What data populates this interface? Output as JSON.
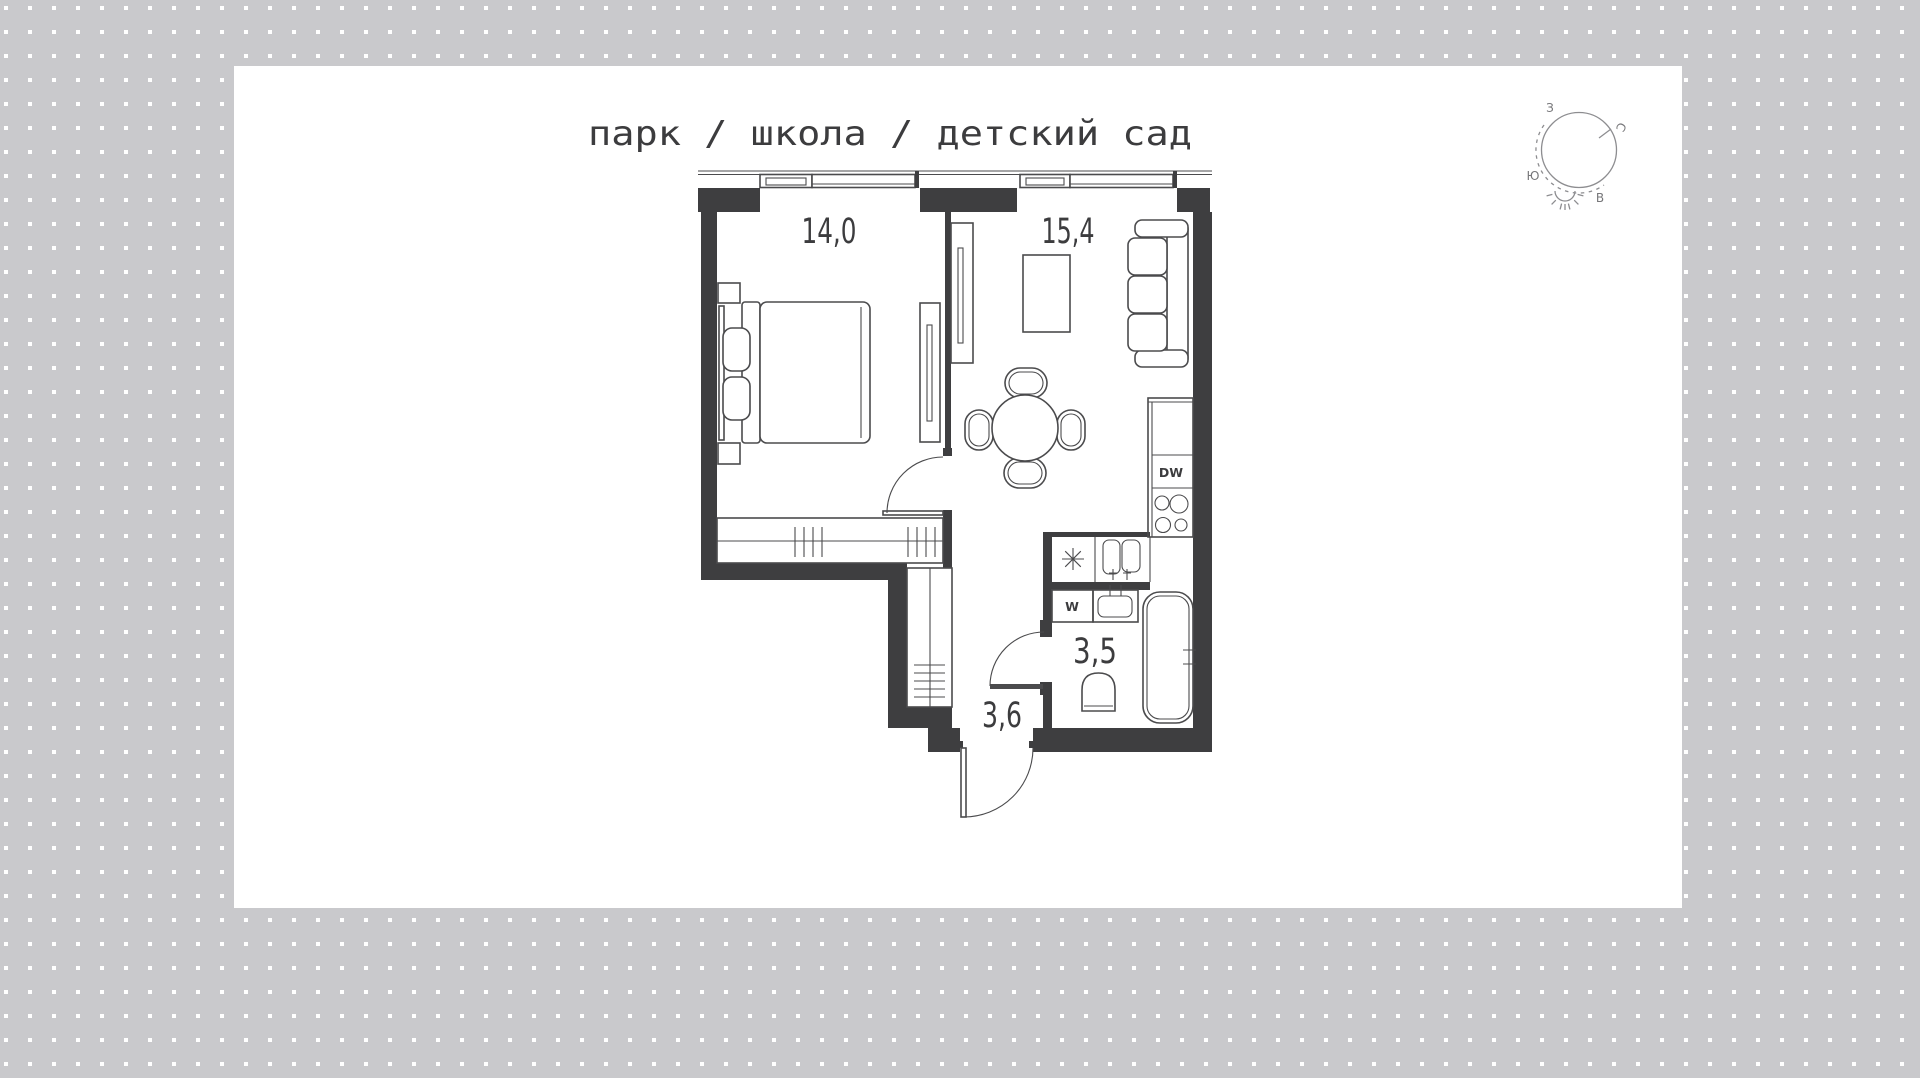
{
  "title": {
    "text": "парк / школа / детский сад"
  },
  "floor_plan": {
    "rooms": [
      {
        "name": "bedroom",
        "area": "14,0"
      },
      {
        "name": "living-kitchen",
        "area": "15,4"
      },
      {
        "name": "bathroom",
        "area": "3,5"
      },
      {
        "name": "hallway",
        "area": "3,6"
      }
    ],
    "appliances": {
      "dishwasher": "DW",
      "washer": "W"
    },
    "icons": {
      "utility_shaft": "asterisk-8-spoke",
      "sun": "sun-with-rays",
      "doors": "quarter-arc-swing"
    }
  },
  "compass": {
    "north": "С",
    "east": "В",
    "south": "Ю",
    "west": "З"
  },
  "colors": {
    "wall": "#3e3e40",
    "line": "#4b4b4d",
    "text": "#3c3c3e",
    "dot": "#c9c9cc",
    "background": "#ffffff",
    "card": "#ffffff",
    "compass_line": "#8d8d90"
  }
}
